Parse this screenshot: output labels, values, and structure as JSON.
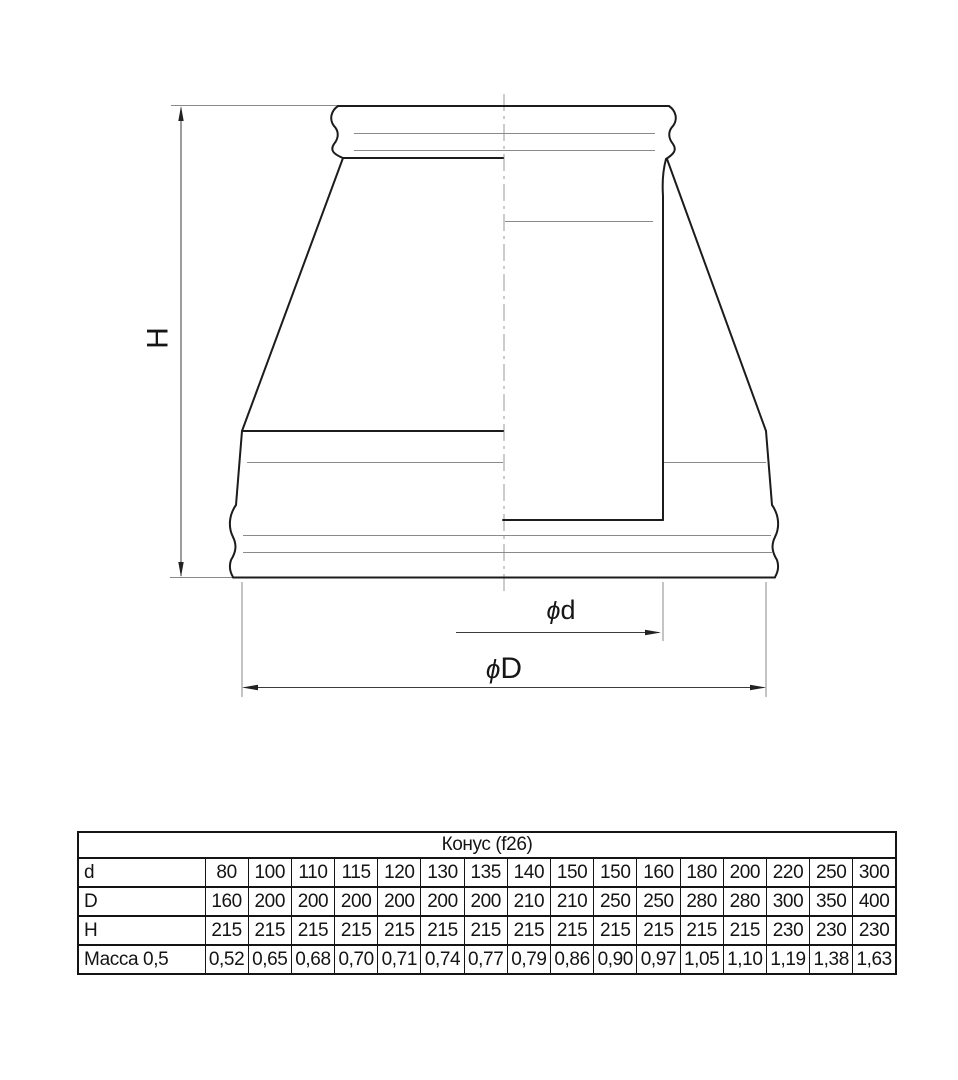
{
  "drawing": {
    "height_label": "H",
    "diameter_symbol": "ϕ",
    "inner_diameter_label": "d",
    "outer_diameter_label": "D"
  },
  "table": {
    "title": "Конус (f26)",
    "rows": [
      {
        "label": "d",
        "values": [
          "80",
          "100",
          "110",
          "115",
          "120",
          "130",
          "135",
          "140",
          "150",
          "150",
          "160",
          "180",
          "200",
          "220",
          "250",
          "300"
        ]
      },
      {
        "label": "D",
        "values": [
          "160",
          "200",
          "200",
          "200",
          "200",
          "200",
          "200",
          "210",
          "210",
          "250",
          "250",
          "280",
          "280",
          "300",
          "350",
          "400"
        ]
      },
      {
        "label": "H",
        "values": [
          "215",
          "215",
          "215",
          "215",
          "215",
          "215",
          "215",
          "215",
          "215",
          "215",
          "215",
          "215",
          "215",
          "230",
          "230",
          "230"
        ]
      },
      {
        "label": "Масса 0,5",
        "values": [
          "0,52",
          "0,65",
          "0,68",
          "0,70",
          "0,71",
          "0,74",
          "0,77",
          "0,79",
          "0,86",
          "0,90",
          "0,97",
          "1,05",
          "1,10",
          "1,19",
          "1,38",
          "1,63"
        ]
      }
    ]
  },
  "colors": {
    "contour": "#1c1c1c",
    "thin_line": "#8a8a8a",
    "dimension_line": "#3a3a3a",
    "centerline": "#9a9a9a",
    "background": "#ffffff"
  }
}
